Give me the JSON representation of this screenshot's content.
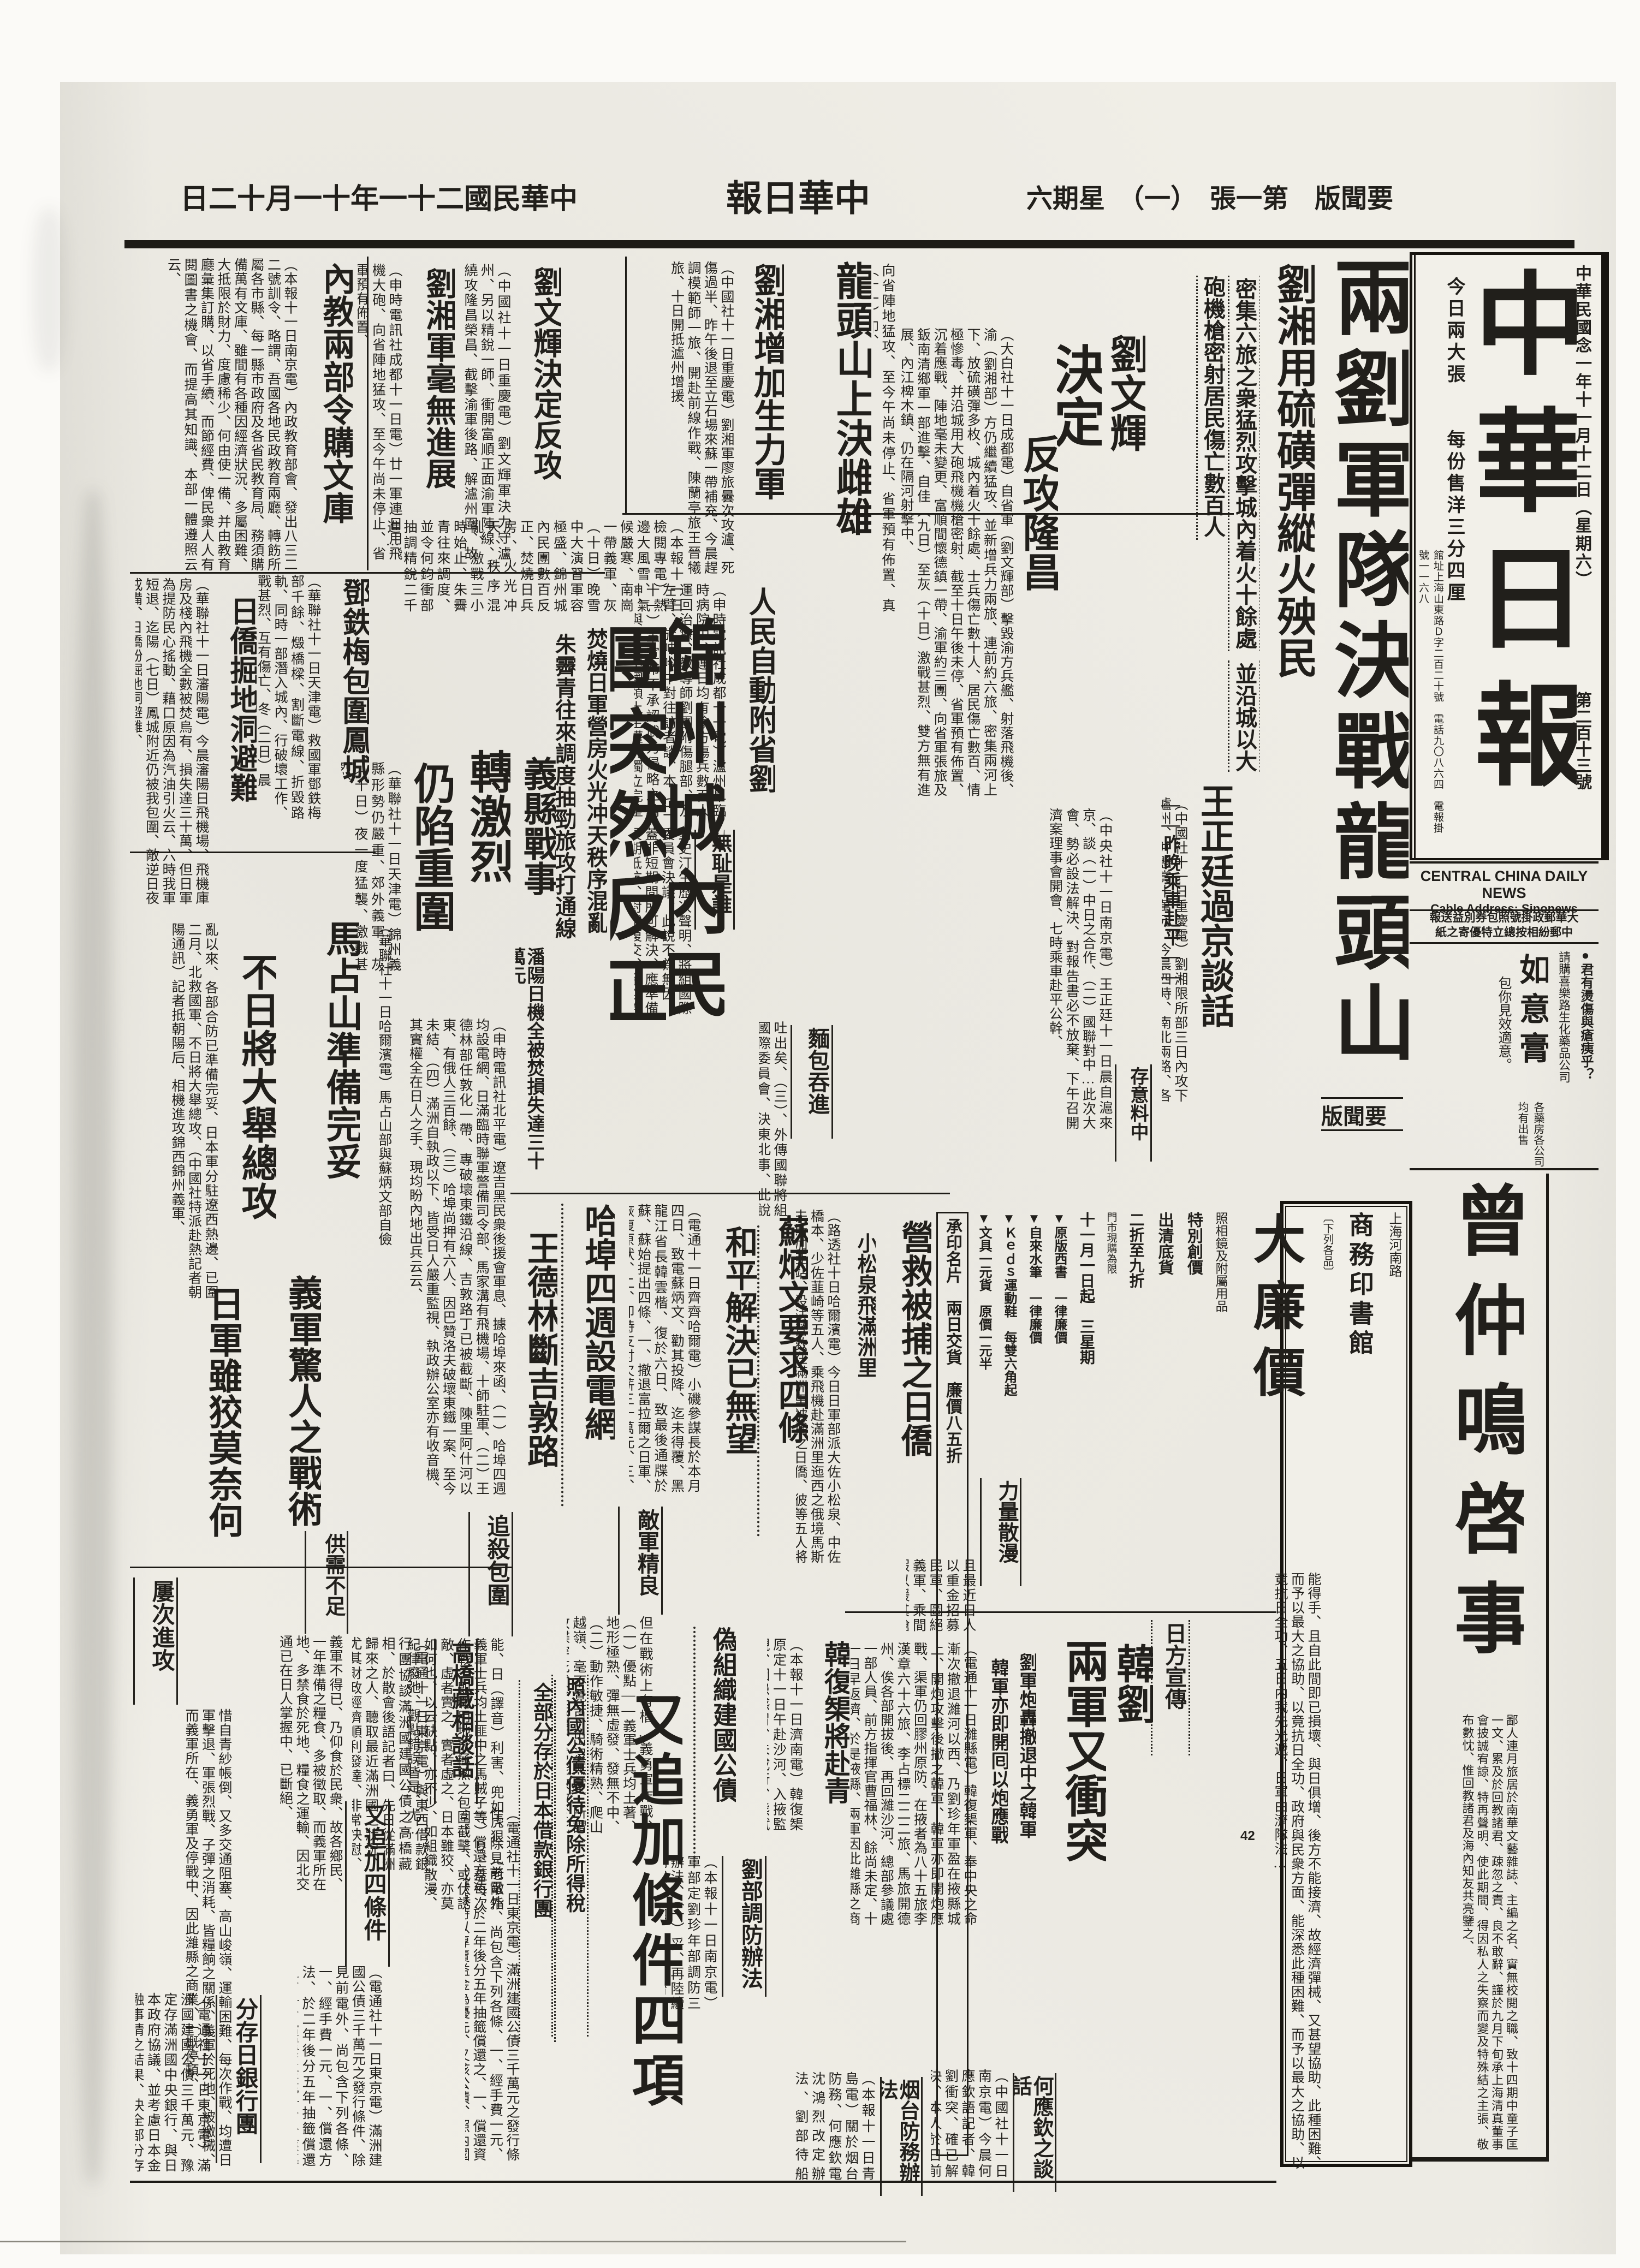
{
  "edition_line": {
    "date": "中華民國二十一年十一月十二日",
    "paper": "中華日報",
    "edition": "要聞版　第一張　（一）　星期六"
  },
  "masthead": {
    "title": "中華日報",
    "date_line": "中華民國念一年十一月十二日（星期六）",
    "issue_no": "第二百十三號",
    "sheets": "今日兩大張",
    "price": "每份售洋三分四厘",
    "address": "館址上海山東路Ｄ字二百二十號　電話九〇八六四　電報掛號一一六八",
    "english_name": "CENTRAL CHINA DAILY NEWS",
    "cable_address": "Cable Address:  Sinonews",
    "postal_line1": "大華郵政掛號照包券別益送報",
    "postal_line2": "中郵紛相按總立特優寄之紙"
  },
  "page_marker": "42",
  "ads": {
    "ruyi": {
      "hook": "●君有燙傷與瘡痍乎？",
      "store": "請購喜樂路生化藥品公司",
      "name": "如意膏",
      "promise": "包你見效適意。",
      "where": "各藥房各公司　均有出售"
    },
    "press": {
      "city": "上海河南路",
      "store": "商務印書館",
      "note": "〔下列各品〕",
      "sale": "大廉價",
      "item_camera": "照相鏡及附屬用品",
      "special": "特別創價",
      "clearance": "出清底貨",
      "discount": "二折至九折",
      "limit": "門市現購為限",
      "period": "十一月一日起　三星期",
      "p1": "▼原版西書　一律廉價",
      "p2": "▼自來水筆　一律廉價",
      "p3": "▼Ｋｅｄｓ運動鞋　每雙六角起",
      "p4": "▼文具一元貨　原價一元半",
      "card": "承印名片　兩日交貨　廉價八五折"
    },
    "zeng": {
      "title": "曾仲鳴啓事",
      "body": "鄙人連月旅居於南華文藝雜誌、主編之名、實無校閱之職、致十四期中童子匡一文、累及於回教諸君、疎忽之責、良不敢辭、謹於九月下旬承上海清真董事會披誠宥諒、特再聲明、使此期間、得因私人之失察而變及特殊結之主張、敬布數忱、惟回教諸君及海內知友共亮鑒之、"
    }
  },
  "articles": [
    {
      "h": "兩劉軍隊決戰龍頭山",
      "label": "要聞版",
      "sub1": "劉湘用硫磺彈縱火殃民",
      "sub2": "密集六旅之衆猛烈攻擊城內着火十餘處",
      "sub3": "並沿城以大砲機槍密射居民傷亡數百人",
      "body": "（中國社十一日重慶電）劉湘限所部三日內攻下瀘州、并懸賞十萬元、今晨四時、南北兩路、各配機關槍二連、同時直衝瀘州城、劉文輝軍禁玉龍楊倚等旅、奮力抗戰、相持歷五小時之久、劉湘軍南路穆部、仍退內口渡、北路陣綫未動、是役兩方死傷均在千人以上、"
    },
    {
      "h1": "劉文輝",
      "h2": "決定",
      "h3": "反攻隆昌",
      "body": "（大白社十一日成都電）自省軍（劉文輝部）擊毀渝方兵艦、射落飛機後、渝（劉湘部）方仍繼續猛攻、並新增兵力兩旅、連前約六旅、密集兩河上下、放硫磺彈多枚、城內着火十餘處、士兵傷亡數十人、居民傷亡數百、情極慘毒、并沿城用大砲飛機機槍密射、截至十日午後未停、省軍預有佈置、沉着應戰、陣地毫未變更、富順間懷德鎮一帶、渝軍約三團、向省軍張旅及鈑南清鄉軍一部進擊、自佳（九日）至灰（十日）激戰甚烈、雙方無有進展、內江椑木鎮、仍在隔河射擊中、"
    },
    {
      "h": "龍頭山上決雌雄",
      "body": "向省陣地猛攻、至今午尚未停止、省軍預有佈置、真（十一）印、"
    },
    {
      "h": "劉湘增加生力軍",
      "body": "（中國社十一日重慶電）劉湘軍廖旅曇次攻瀘、死傷過半、昨午後退至立石場來蘇一帶補充、今晨趕調模範師一旅、開赴前線作戰、陳蘭亭旅王晉犧旅、十日開抵瀘州增援、"
    },
    {
      "h": "王正廷過京談話",
      "sub": "——昨晚乘車赴平——",
      "kick": "存意料中",
      "body": "（中央社十一日南京電）王正廷十一日晨自滬來京、談（一）中日之合作、（二）國聯對中…此次大會、勢必設法解決、對報告書必不放棄、下午召開濟案理事會開會、七時乘車赴平公幹、"
    },
    {
      "h": "人民自動附省劉",
      "kick": "無耻是誰",
      "body": "（申時電訊社成都十一電）瀘州阜臨時病院中、連日均有渝方傷兵數百人運回治療、教導師劉團附傷腿部、及左臂、於呻吟中對往訪者談、本（二十一）軍宣布不承認武力侵略之精神、與尊重中國領土主權的獨立完整之主張、則可確信不變、",
      "body2": "對史汀生歷次聲明、將組國際委員會決議、此說不為無因、蓋非短期間所可解決、應準備長期抵抗、對俄復交、余以為可行、日俄絕不侵犯條約、"
    },
    {
      "hA": "錦州城內民",
      "hB": "團突然反正",
      "sub1": "焚燒日軍營房火光冲天秩序混亂",
      "sub2": "朱霽青往來調度抽勁旅攻打通線",
      "sub3": "潘陽日機全被焚損失達三十萬元",
      "body": "（本報十一日檢閱專電）熱邊大風雪、氣候嚴寒、南崗一帶義軍、灰（十日）晚雪中大演習軍容極盛、錦州城內民團數百反正、焚燒日兵房、火光冲天、秩序混亂、激戰三小時始止、朱霽青往來調度、並令何鈞衝部抽調精銳二千進…"
    },
    {
      "h1": "義縣戰事",
      "h2": "轉激烈",
      "h3": "仍陷重圍",
      "body": "（華聯社十一日天津電）錦州義縣形勢仍嚴重、郊外義軍、灰（十日）夜一度猛襲、激戰甚烈、"
    },
    {
      "h": "鄧鉄梅包圍鳳城",
      "body": "（華聯社十一日天津電）救國軍鄧鉄梅部千餘、燬橋樑、割斷電線、折毀路軌、同時一部潛入城內、行破壞工作、戰甚烈、互有傷亡、冬（二日）晨"
    },
    {
      "h": "日僑掘地洞避難",
      "body": "（華聯社十一日瀋陽電）今晨瀋陽日飛機場、飛機庫房及棧內飛機全數被焚烏有、損失達三十萬、但日軍為提防民心搖動、藉口原因為汽油引火云、六時我軍短退、迄陽（七日）鳳城附近仍被我包圍、敵逆日夜戒備、日僑紛掘地洞避難、"
    },
    {
      "h": "內教兩部令購文庫",
      "body": "（本報十一日南京電）內政教育部會、發出八三二二號訓令、略謂、吾國各地民政教育兩廳、轉飭所屬各市縣、每一縣市政府及各省民教育局、務須購備萬有文庫、雖間有各種因經濟狀況、多屬困難、大抵限於財力、度慮稀少、何由使一備、并由教育廳彙集訂購、以省手續、而節經費、俾民衆人人有閱圖書之機會、而提高其知識、本部一體遵照云云、"
    },
    {
      "h": "劉湘軍毫無進展",
      "body": "（申時電訊社成都十一日電）廿一軍連日用飛機大砲、向省陣地猛攻、至今午尚未停止、省軍預有佈置、"
    },
    {
      "h": "劉文輝決定反攻",
      "body": "（中國社十一日重慶電）劉文輝軍決力守瀘州、另以精銳一師、衝開富順正面渝軍陣線、繞攻隆昌榮昌、截擊渝軍後路、解瀘州圍、故日來戰事甚烈、"
    },
    {
      "hA": "馬占山準備完妥",
      "hB": "不日將大舉總攻",
      "bodyR": "（華聯社十一日哈爾濱電）馬占山部與蘇炳文部自儉",
      "bodyL": "亂以來、各部合防已準備完妥、日本軍分駐遼西熱邊、已圍二月、北救國軍、不日將大舉總攻、（中國社特派赴熱記者朝陽通訊）記者抵朝陽后、相機進攻錦西錦州義軍、"
    },
    {
      "hA": "義軍驚人之戰術",
      "hB": "日軍雖狡莫奈何",
      "kick": "屢次進攻",
      "body": "惜自青紗帳倒、又多交通阻塞、高山峻嶺、運輸困難、每次作戰、均遭日軍擊退、軍張烈戰、子彈之消耗、皆糧餉之關係、義軍於死地、被繳械、而義軍所在、義勇軍及停戰中、因此濰縣之商業、一概停頓、"
    },
    {
      "kick": "供需不足",
      "body": "義軍不得已、乃仰食於民衆、故各鄉民、一年準備之糧食、多被徵取、而義軍所在地、多禁食於死地、糧食之運輸、因北交通已在日人掌握中、已斷絕、"
    },
    {
      "kick": "追殺包圍",
      "body": "能、日（譯音）利害、兜如虎狠、（老敵指義軍士兵均土匪中之馬賊子等）Ｄ、蓋每次作戰、即利用地形極熟之包圍截擊、或伏誘敵、虛者實之、實者虛之、日本雖狡、亦莫如何也、以云缺點、亦不少、如組織散漫、紀律廢弛、觀點錯誤皆是、尤…"
    },
    {
      "kick": "敵軍精良",
      "body": "但在戰術上有楷…義勇軍作戰、（一）優點——義軍士兵均土著、地形極熟、彈無虛發、發無不中、（二）動作敏捷、騎術精熟、爬山越嶺、毫不覺苦、出沒無常、所謂致楪穿花式之戰略、常能致敵於死命者、即此故也、二、勇於衝鋒——義軍遇敵迎戰、即一往直前、銳不可當、敵人陣綫一被衝、"
    },
    {
      "hA": "蘇炳文要求四條",
      "hB": "和平解決已無望",
      "body": "（電通十一日齊齊哈爾電）小磯參謀長於本月四日、致電蘇炳文、勸其投降、迄未得覆、黑龍江省長韓雲楷、復於六日、致最後通牒於蘇、蘇始提出四條、一、撤退富拉爾之日軍、恢復原狀、二、即時支付欠薪三十萬元、三、滿洲國須表示誠意、四、日本軍雖一兵不得入呼倫貝爾、是蘇尚持傲慢不遜之態度、和平解決、到底無望、日方不得不採最后手段云、"
    },
    {
      "h": "營救被捕之日僑",
      "sub": "小松泉飛滿洲里",
      "body": "（路透社十日哈爾濱電）今日日軍部派大佐小松泉、中佐橋本、少佐韮崎等五人、乘飛機赴滿洲里迤西之俄境馬斯夫斯加亞站、設法營救在滿洲里被捕之日僑、彼等五人將在齊齊哈爾過宿、明日清晨飛往俄境、將有「滿洲國」官吏數人、與彼等同赴俄境者云、"
    },
    {
      "h": "哈埠四週設電網",
      "body": "（申時電訊社北平電）遼吉黑民衆後援會軍息、據哈埠來函、（一）哈埠四週均設電網、日滿臨時聯軍警備司令部、馬家溝有飛機場、十師駐軍、（二）王德林部任敦化一帶、專破壞東鐵沿線、吉敦路丁已被截斷、陳里阿什河以東、有俄人三百餘、（三）哈埠尚押有六人、因巴贊洛夫破壞東鐵一案、至今未結、（四）滿洲自執政以下、皆受日人嚴重監視、執政辦公室亦有收音機、其實權全在日人之手、現均盼內地出兵云云、"
    },
    {
      "h": "王德林斷吉敦路"
    },
    {
      "kick": "麵包吞進",
      "body": "吐出矣、（三）、外傳國聯將組國際委員會、決東北事、此說不為無因、蓋東北義軍、已使日人疲於奔命、日本對東三省當…去、必…"
    },
    {
      "kick": "力量散漫",
      "body": "且最近日人以重金招募民軍、圖絕義軍、乘間假以鍰其鎗械、復運掖…"
    },
    {
      "hA": "韓劉",
      "hB": "兩軍又衝突",
      "kick": "日方宣傳",
      "sub1": "劉軍炮轟撤退中之韓軍",
      "sub2": "韓軍亦即開囘以炮應戰",
      "body": "（電通十一日濰縣電）韓復榘軍、奉中央之命漸次撤退濰河以西、乃劉珍年軍盈在掖縣城上、開炮攻擊後撤之韓軍、韓軍亦即開炮應戰、渠軍仍回膠州原防、在掖者為八十五旅李漢章六十六旅、李占標二二二旅、馬旅開德州、俟各部開拔後、再回濰沙河、總部參議處一部人員、前方指揮官曹福林、餘尚未定、十一日早返濟、於是掖縣、兩軍因此濰縣之商業、半日正午起、一概停頓、"
    },
    {
      "kick": "何應欽之談話",
      "body": "（中國社十一日南京電）今晨何應欽語記者、韓劉衝突、確已解決、本人於日前電沈鴻烈、改定接收烟台防務辦法、沈昨已電復遵辦、現…"
    },
    {
      "kick": "烟台防務辦法",
      "body": "（本報十一日青島電）關於烟台防務、何應欽電沈鴻烈改定辦法、劉部待船到、即陸續開拔、由煙登輪、船隻係由軍部租用、計有五艘、到烟後即將劉部載運大埔、再由隴海線轉京漢線南下、"
    },
    {
      "kick": "劉部調防辦法",
      "body": "（本報十一日南京電）軍部定劉珍年部調防三辦法、（一）妥、再陸續開拔、（四）現時烟台防務所配置及保護外僑等事、（三）已電劉師、待船隻變備、免在烟台防務、謂已遵照辦理云、"
    },
    {
      "h": "韓復榘將赴青",
      "body": "（本報十一日濟南電）韓復榘原定十一日午赴沙河、入掖監視、因患感冒、未成行、熊斌十一日南下一行、不用接管、惟在使用碼頭、准其自派衛兵、劉師最好到時、韓軍完全負責、"
    },
    {
      "h1": "偽組織建國公債",
      "h2": "又追加條件四項",
      "sub1": "照內國公債優待免除所得稅",
      "sub2": "全部分存於日本借款銀行團"
    },
    {
      "kick": "高橋藏相談話",
      "body": "（電通十一日東京電）與東西借款銀行團協談滿洲國建國公債之高橋藏相、於散會後語記者曰、先日從滿洲歸來之人、聽取最近滿洲國之狀況、尤其財政經濟順利發達、非常快慰、日本方面、無論政府國民、皆不可不援助滿洲國、使之長成、前在銀行團會合席上、有人提出公債之事、旋即意外進步、均允承受、今日乃銀行團來詢政府之意見耳、此誠佳事、希望今後以此為實物教訓、對滿洲國與以資金之援助、所以請外相出席者、因有外交上之關係、且有担保問題、"
    },
    {
      "kick": "又追加四條件",
      "body": "（電通社十一日東京電）滿洲建國公債三千萬元之發行條件、除見前電外、尚包含下列各條、一、經手費一元、一、償還方法、於二年後分五年抽籤償還之、一、償還資金充一、於應募時以專賣益金為優先、又該公債、照內國債優遇、並免除該公債所有者之所得稅、日本銀行亦允以該公債作担保、至關於滿洲國對該公債之担保、內容注目、"
    },
    {
      "kick": "分存日銀行團",
      "body": "（電通社十一日東京電）滿洲國建國公債三千萬元、豫定存滿洲國中央銀行、與日本政府協議、並考慮日本金融事情之結果、決全部分存於日本借款銀行團、設定滿洲國最初之在外現金制度、而存款銀行團、為銀本位國、然中央銀行、現在滿洲國、有六成現金、可有八成、加入此次存款、現金準備、爹將來到達金匯兌本位制之一段階、發行銀券、"
    },
    {
      "body": "能得手、且自此間即已損壞、與日俱增、後方不能接濟、故經濟彈械、又甚望協助、此種困難、而予以最大之協助、以竟抗日全功、政府與民衆方面、能深悉此種困難、而予以最大之協助、以竟抗日全功、五日內我先光遞、日軍由濟隊法…"
    }
  ]
}
